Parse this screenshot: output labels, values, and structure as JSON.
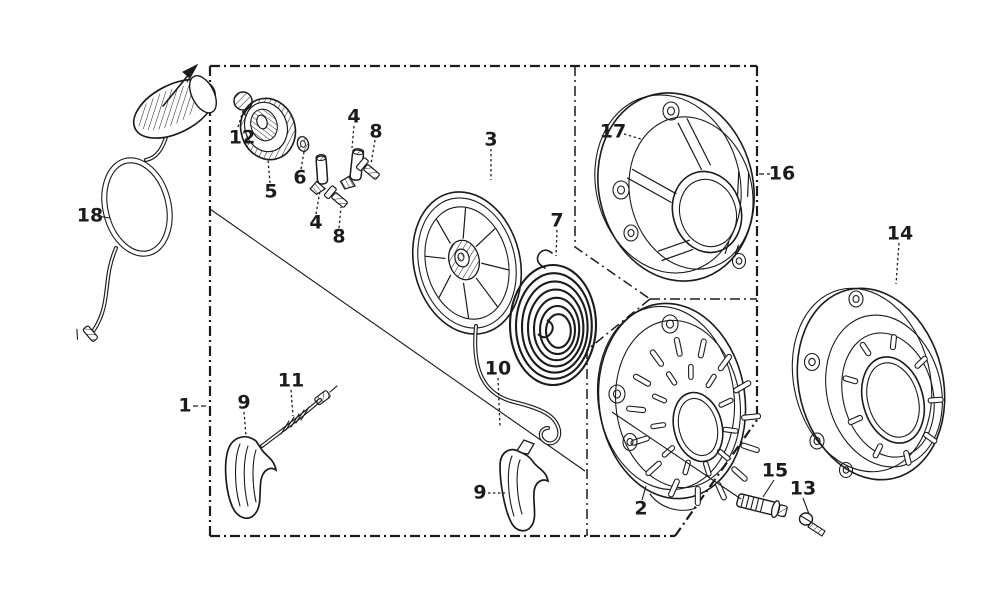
{
  "page": {
    "background": "#ffffff",
    "ink": "#1b1b1b"
  },
  "diagram": {
    "type": "exploded-parts-diagram",
    "subject": "recoil starter assembly",
    "callouts": [
      {
        "part": "1",
        "x": 185,
        "y": 406
      },
      {
        "part": "2",
        "x": 641,
        "y": 509
      },
      {
        "part": "3",
        "x": 491,
        "y": 140
      },
      {
        "part": "4",
        "x": 354,
        "y": 117
      },
      {
        "part": "4",
        "x": 316,
        "y": 223
      },
      {
        "part": "5",
        "x": 271,
        "y": 192
      },
      {
        "part": "6",
        "x": 300,
        "y": 178
      },
      {
        "part": "7",
        "x": 557,
        "y": 221
      },
      {
        "part": "8",
        "x": 376,
        "y": 132
      },
      {
        "part": "8",
        "x": 339,
        "y": 237
      },
      {
        "part": "9",
        "x": 244,
        "y": 403
      },
      {
        "part": "9",
        "x": 480,
        "y": 493
      },
      {
        "part": "10",
        "x": 498,
        "y": 369
      },
      {
        "part": "11",
        "x": 291,
        "y": 381
      },
      {
        "part": "12",
        "x": 242,
        "y": 138
      },
      {
        "part": "13",
        "x": 803,
        "y": 489
      },
      {
        "part": "14",
        "x": 900,
        "y": 234
      },
      {
        "part": "15",
        "x": 775,
        "y": 471
      },
      {
        "part": "16",
        "x": 782,
        "y": 174
      },
      {
        "part": "17",
        "x": 613,
        "y": 132
      },
      {
        "part": "18",
        "x": 90,
        "y": 216
      }
    ]
  }
}
